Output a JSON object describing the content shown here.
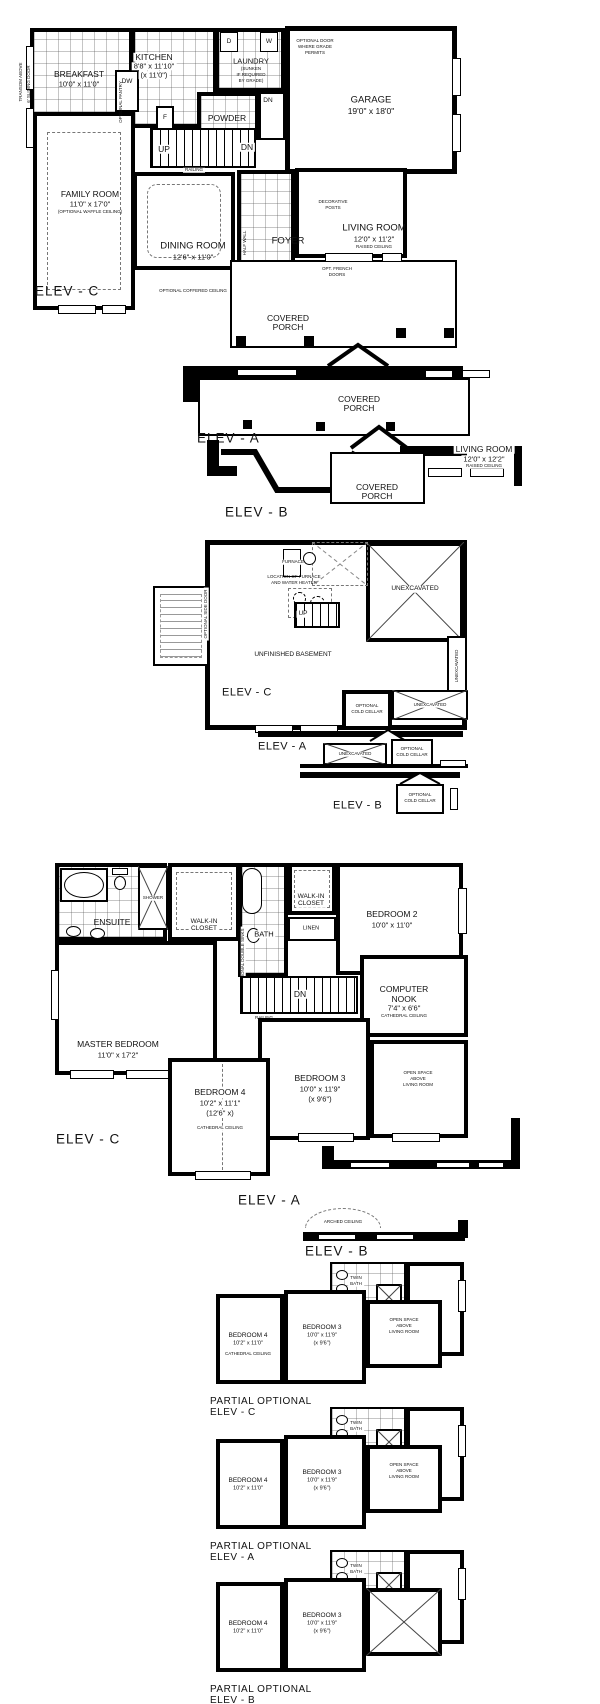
{
  "sheet": {
    "bg": "#ffffff",
    "ink": "#000000"
  },
  "common": {
    "covered": "COVERED",
    "porch": "PORCH",
    "up": "UP",
    "dn": "DN",
    "railing": "RAILING",
    "unexcavated": "UNEXCAVATED",
    "optional": "OPTIONAL",
    "cold_cellar": "COLD CELLAR",
    "walk_in": "WALK-IN",
    "closet": "CLOSET",
    "linen": "LINEN",
    "cathedral_ceiling": "CATHEDRAL CEILING",
    "raised_ceiling": "RAISED CEILING",
    "living_room": "LIVING ROOM",
    "elev_a": "ELEV - A",
    "elev_b": "ELEV - B",
    "elev_c": "ELEV - C",
    "partial_optional": "PARTIAL OPTIONAL"
  },
  "main_floor": {
    "transom_note": "TRANSOM ABOVE",
    "sliding_door_note": "6' SLIDING DOOR",
    "breakfast_name": "BREAKFAST",
    "breakfast_dims": "10'0\" x 11'0\"",
    "kitchen_name": "KITCHEN",
    "kitchen_dims": "8'8\" x 11'10\"",
    "kitchen_dims2": "(x 11'0\")",
    "dw": "DW",
    "fridge": "F",
    "pantry_note": "OPTIONAL PANTRY",
    "laundry_name": "LAUNDRY",
    "laundry_note1": "(SUNKEN",
    "laundry_note2": "IF REQUIRED",
    "laundry_note3": "BY GRADE)",
    "washer": "W",
    "dryer": "D",
    "grade_door_note1": "OPTIONAL DOOR",
    "grade_door_note2": "WHERE GRADE",
    "grade_door_note3": "PERMITS",
    "garage_name": "GARAGE",
    "garage_dims": "19'0\" x 18'0\"",
    "powder": "POWDER",
    "family_name": "FAMILY ROOM",
    "family_dims": "11'0\" x 17'0\"",
    "family_note": "(OPTIONAL WAFFLE CEILING)",
    "dining_name": "DINING ROOM",
    "dining_dims": "12'6\" x 11'0\"",
    "coffered_note": "OPTIONAL COFFERED CEILING",
    "half_wall": "HALF WALL",
    "foyer": "FOYER",
    "dec_posts_1": "DECORATIVE",
    "dec_posts_2": "POSTS",
    "living_dims": "12'0\" x 11'2\"",
    "french_1": "OPT. FRENCH",
    "french_2": "DOORS"
  },
  "elev_front": {
    "living_dims_b": "12'0\" x 12'2\""
  },
  "basement": {
    "furnace": "FURNACE",
    "furnace_note1": "LOCATION OF FURNACE",
    "furnace_note2": "AND WATER HEATER",
    "side_door_note": "OPTIONAL SIDE DOOR",
    "unfinished": "UNFINISHED BASEMENT"
  },
  "second_floor": {
    "ensuite": "ENSUITE",
    "shower": "SHOWER",
    "bath": "BATH",
    "double_sinks_note": "OPTIONAL DOUBLE SINKS",
    "bedroom2_name": "BEDROOM 2",
    "bedroom2_dims": "10'0\" x 11'0\"",
    "nook_name1": "COMPUTER",
    "nook_name2": "NOOK",
    "nook_dims": "7'4\" x 6'6\"",
    "master_name": "MASTER BEDROOM",
    "master_dims": "11'0\" x 17'2\"",
    "bedroom3_name": "BEDROOM 3",
    "bedroom3_dims": "10'0\" x 11'9\"",
    "bedroom3_dims2": "(x 9'6\")",
    "bedroom4_name": "BEDROOM 4",
    "bedroom4_dims": "10'2\" x 11'1\"",
    "bedroom4_dims2": "(12'6\" x)",
    "open_space_1": "OPEN SPACE",
    "open_space_2": "ABOVE",
    "open_space_3": "LIVING ROOM",
    "arched_ceiling": "ARCHED CEILING"
  },
  "partials": {
    "bath_1": "TWIN",
    "bath_2": "BATH",
    "bedroom4_name": "BEDROOM 4",
    "bedroom4_dims": "10'2\" x 11'0\"",
    "bedroom3_name": "BEDROOM 3",
    "bedroom3_dims": "10'0\" x 11'9\"",
    "bedroom3_dims2": "(x 9'6\")"
  }
}
